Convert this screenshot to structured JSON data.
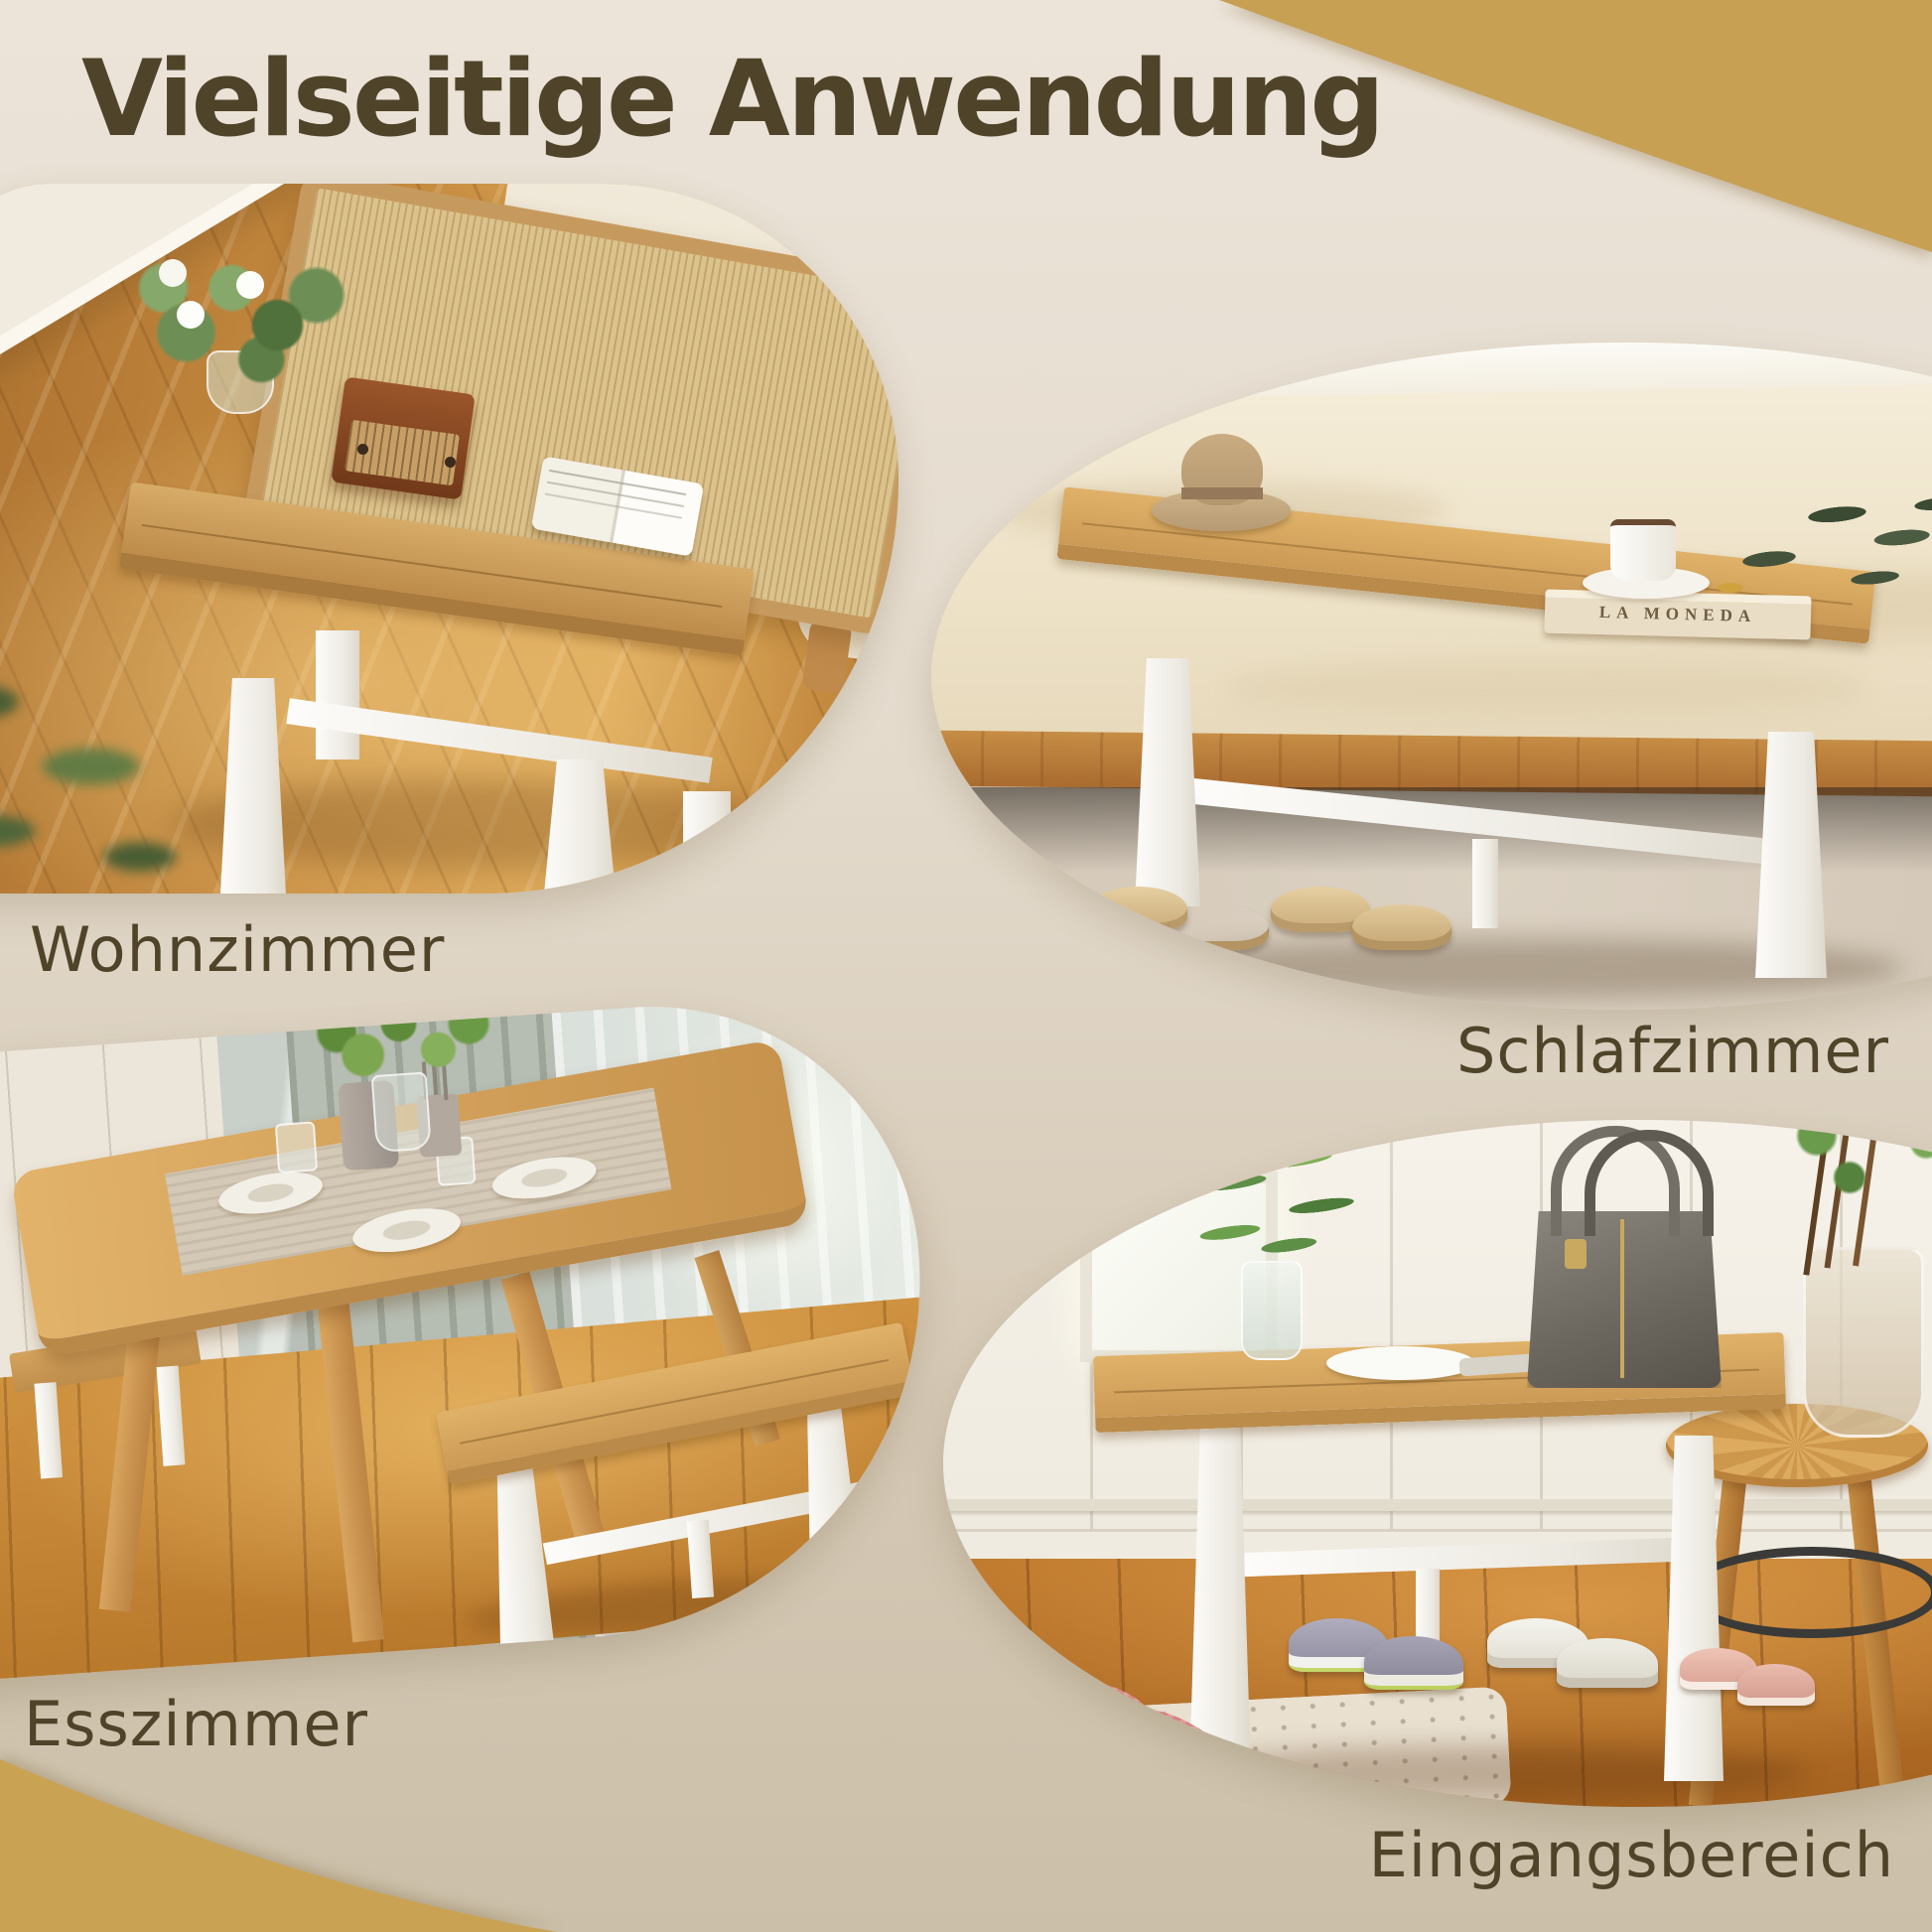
{
  "page": {
    "title": "Vielseitige Anwendung",
    "background_top": "#ece4d9",
    "background_bottom": "#cbbfa9",
    "accent_gold": "#c8a053",
    "heading_color": "#4f4429"
  },
  "sections": [
    {
      "id": "wohnzimmer",
      "label": "Wohnzimmer",
      "description": "Holzbank mit weissen Beinen vor einem Daybed mit Rattan-Lehne, Blumen, Retro-Radio und aufgeschlagenem Buch auf Parkettboden"
    },
    {
      "id": "schlafzimmer",
      "label": "Schlafzimmer",
      "description": "Bank am Fussende des Bettes mit Hut, Kaffeetasse, Buch und Zweig, Hausschuhe darunter"
    },
    {
      "id": "esszimmer",
      "label": "Esszimmer",
      "description": "Esstisch aus hellem Holz mit zwei Baenken, gedeckt mit Tellern, Laeufer und Pflanze"
    },
    {
      "id": "eingangsbereich",
      "label": "Eingangsbereich",
      "description": "Bank mit grauer Handtasche und Glasvase, Schuhe und Hausschuhe darunter, runder Beistelltisch"
    }
  ],
  "photo_texts": {
    "book_spine": "LA MONEDA"
  }
}
